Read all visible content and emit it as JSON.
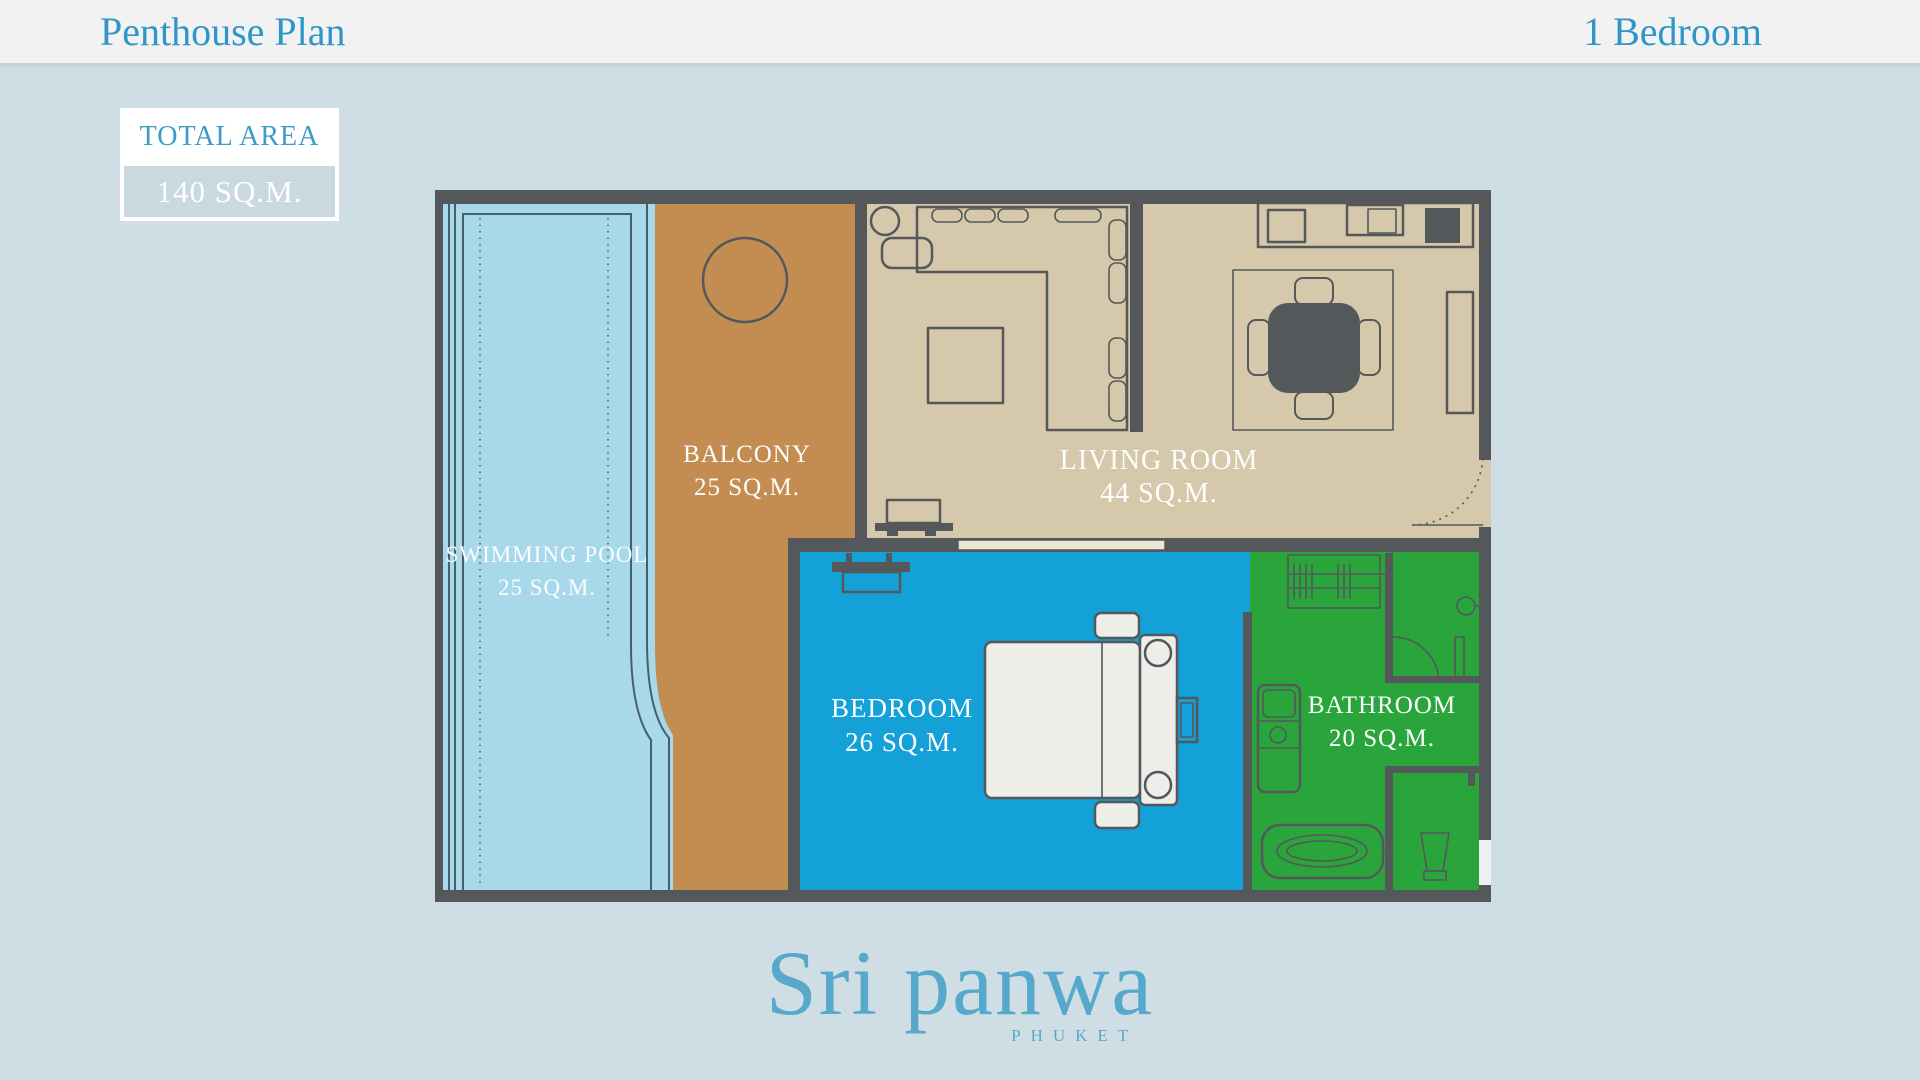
{
  "header": {
    "title": "Penthouse Plan",
    "subtitle": "1 Bedroom"
  },
  "total_area": {
    "label": "TOTAL AREA",
    "value": "140 SQ.M."
  },
  "rooms": {
    "swimming_pool": {
      "name": "SWIMMING POOL",
      "area": "25 SQ.M."
    },
    "balcony": {
      "name": "BALCONY",
      "area": "25 SQ.M."
    },
    "living_room": {
      "name": "LIVING ROOM",
      "area": "44 SQ.M."
    },
    "bedroom": {
      "name": "BEDROOM",
      "area": "26 SQ.M."
    },
    "bathroom": {
      "name": "BATHROOM",
      "area": "20 SQ.M."
    }
  },
  "brand": {
    "name": "Sri panwa",
    "location": "PHUKET"
  },
  "colors": {
    "accent_blue": "#2e96c8",
    "page_background": "#cfdee4",
    "header_background": "#f2f2f2",
    "wall": "#54585b",
    "pool": "#a7d9eb",
    "balcony": "#c38d52",
    "living_room": "#d6c9ab",
    "bedroom": "#14a1d8",
    "bathroom": "#2aa53c",
    "label_text": "#fdfdfd",
    "logo_blue": "#57a9cb"
  }
}
